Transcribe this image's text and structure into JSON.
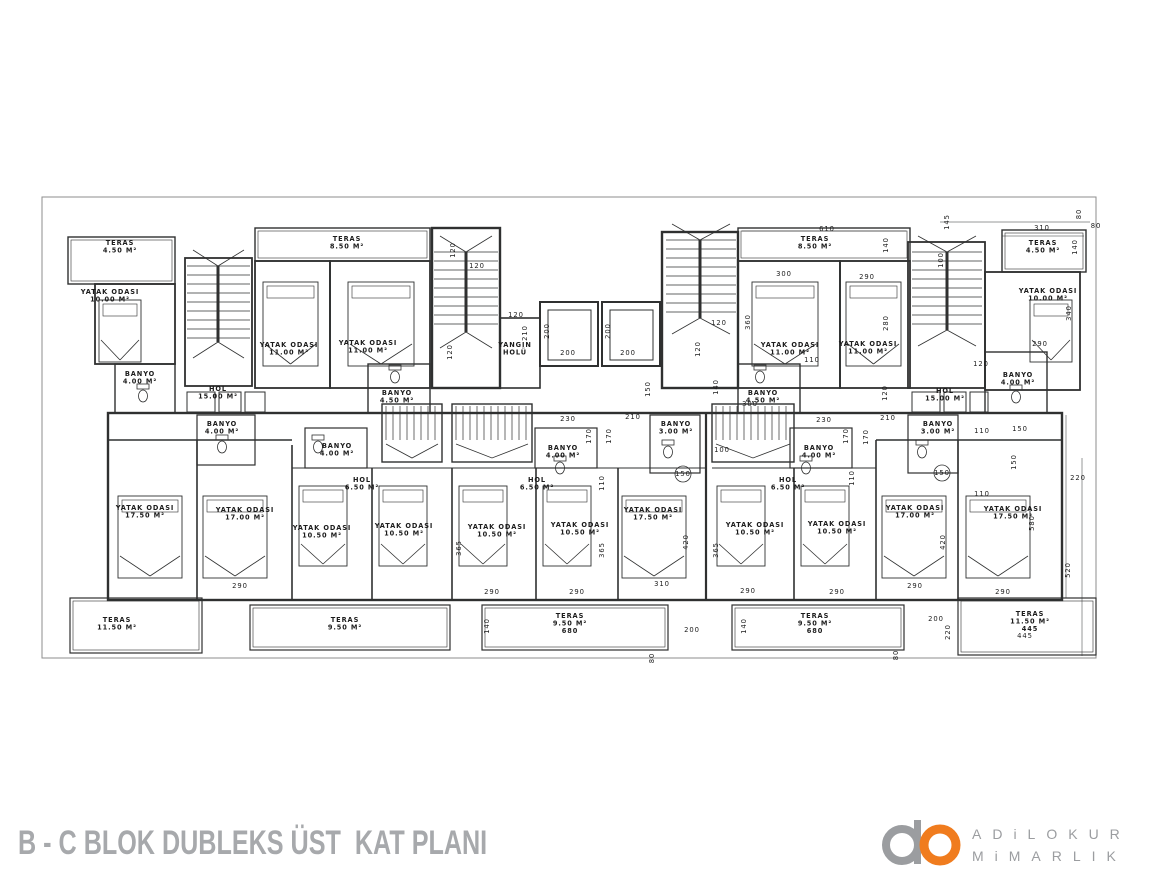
{
  "meta": {
    "title": "B - C BLOK DUBLEKS ÜST  KAT PLANI"
  },
  "logo": {
    "line1": "ADiLOKUR",
    "line2": "MiMARLIK",
    "gray": "#9b9da0",
    "orange": "#f07c1e"
  },
  "colors": {
    "line": "#2f3030",
    "boundary": "#8d8d8d",
    "label": "#1c1c1c",
    "title": "#a7a9ac"
  },
  "plan": {
    "rooms": [
      {
        "l1": "TERAS",
        "l2": "4.50 M²",
        "x": 120,
        "y": 245
      },
      {
        "l1": "YATAK ODASI",
        "l2": "10.00 M²",
        "x": 110,
        "y": 294
      },
      {
        "l1": "BANYO",
        "l2": "4.00 M²",
        "x": 140,
        "y": 376
      },
      {
        "l1": "HOL",
        "l2": "15.00 M²",
        "x": 218,
        "y": 391
      },
      {
        "l1": "TERAS",
        "l2": "8.50 M²",
        "x": 347,
        "y": 241
      },
      {
        "l1": "YATAK ODASI",
        "l2": "11.00 M²",
        "x": 289,
        "y": 347
      },
      {
        "l1": "YATAK ODASI",
        "l2": "11.00 M²",
        "x": 368,
        "y": 345
      },
      {
        "l1": "BANYO",
        "l2": "4.50 M²",
        "x": 397,
        "y": 395
      },
      {
        "l1": "YANGIN",
        "l2": "HOLÜ",
        "x": 515,
        "y": 347
      },
      {
        "l1": "TERAS",
        "l2": "8.50 M²",
        "x": 815,
        "y": 241
      },
      {
        "l1": "YATAK ODASI",
        "l2": "11.00 M²",
        "x": 790,
        "y": 347
      },
      {
        "l1": "YATAK ODASI",
        "l2": "11.00 M²",
        "x": 868,
        "y": 346
      },
      {
        "l1": "BANYO",
        "l2": "4.50 M²",
        "x": 763,
        "y": 395
      },
      {
        "l1": "HOL",
        "l2": "15.00 M²",
        "x": 945,
        "y": 393
      },
      {
        "l1": "TERAS",
        "l2": "4.50 M²",
        "x": 1043,
        "y": 245
      },
      {
        "l1": "YATAK ODASI",
        "l2": "10.00 M²",
        "x": 1048,
        "y": 293
      },
      {
        "l1": "BANYO",
        "l2": "4.00 M²",
        "x": 1018,
        "y": 377
      },
      {
        "l1": "BANYO",
        "l2": "4.00 M²",
        "x": 222,
        "y": 426
      },
      {
        "l1": "BANYO",
        "l2": "4.00 M²",
        "x": 337,
        "y": 448
      },
      {
        "l1": "BANYO",
        "l2": "4.00 M²",
        "x": 563,
        "y": 450
      },
      {
        "l1": "BANYO",
        "l2": "3.00 M²",
        "x": 676,
        "y": 426
      },
      {
        "l1": "BANYO",
        "l2": "4.00 M²",
        "x": 819,
        "y": 450
      },
      {
        "l1": "BANYO",
        "l2": "3.00 M²",
        "x": 938,
        "y": 426
      },
      {
        "l1": "HOL",
        "l2": "6.50 M²",
        "x": 362,
        "y": 482
      },
      {
        "l1": "HOL",
        "l2": "6.50 M²",
        "x": 537,
        "y": 482
      },
      {
        "l1": "HOL",
        "l2": "6.50 M²",
        "x": 788,
        "y": 482
      },
      {
        "l1": "YATAK ODASI",
        "l2": "17.50 M²",
        "x": 145,
        "y": 510
      },
      {
        "l1": "YATAK ODASI",
        "l2": "17.00 M²",
        "x": 245,
        "y": 512
      },
      {
        "l1": "YATAK ODASI",
        "l2": "10.50 M²",
        "x": 322,
        "y": 530
      },
      {
        "l1": "YATAK ODASI",
        "l2": "10.50 M²",
        "x": 404,
        "y": 528
      },
      {
        "l1": "YATAK ODASI",
        "l2": "10.50 M²",
        "x": 497,
        "y": 529
      },
      {
        "l1": "YATAK ODASI",
        "l2": "10.50 M²",
        "x": 580,
        "y": 527
      },
      {
        "l1": "YATAK ODASI",
        "l2": "17.50 M²",
        "x": 653,
        "y": 512
      },
      {
        "l1": "YATAK ODASI",
        "l2": "10.50 M²",
        "x": 755,
        "y": 527
      },
      {
        "l1": "YATAK ODASI",
        "l2": "10.50 M²",
        "x": 837,
        "y": 526
      },
      {
        "l1": "YATAK ODASI",
        "l2": "17.00 M²",
        "x": 915,
        "y": 510
      },
      {
        "l1": "YATAK ODASI",
        "l2": "17.50 M²",
        "x": 1013,
        "y": 511
      },
      {
        "l1": "TERAS",
        "l2": "11.50 M²",
        "x": 117,
        "y": 622
      },
      {
        "l1": "TERAS",
        "l2": "9.50 M²",
        "x": 345,
        "y": 622
      },
      {
        "l1": "TERAS",
        "l2": "9.50 M²",
        "l3": "680",
        "x": 570,
        "y": 618
      },
      {
        "l1": "TERAS",
        "l2": "9.50 M²",
        "l3": "680",
        "x": 815,
        "y": 618
      },
      {
        "l1": "TERAS",
        "l2": "11.50 M²",
        "l3": "445",
        "x": 1030,
        "y": 616
      }
    ],
    "dims": [
      {
        "v": "610",
        "x": 827,
        "y": 231,
        "r": 0
      },
      {
        "v": "140",
        "x": 888,
        "y": 245,
        "r": 1
      },
      {
        "v": "145",
        "x": 949,
        "y": 222,
        "r": 1
      },
      {
        "v": "310",
        "x": 1042,
        "y": 230,
        "r": 0
      },
      {
        "v": "80",
        "x": 1081,
        "y": 214,
        "r": 1
      },
      {
        "v": "80",
        "x": 1096,
        "y": 228,
        "r": 0
      },
      {
        "v": "140",
        "x": 1077,
        "y": 247,
        "r": 1
      },
      {
        "v": "340",
        "x": 1071,
        "y": 313,
        "r": 1
      },
      {
        "v": "290",
        "x": 1040,
        "y": 346,
        "r": 0
      },
      {
        "v": "120",
        "x": 981,
        "y": 366,
        "r": 0
      },
      {
        "v": "100",
        "x": 943,
        "y": 260,
        "r": 1
      },
      {
        "v": "120",
        "x": 455,
        "y": 250,
        "r": 1
      },
      {
        "v": "120",
        "x": 477,
        "y": 268,
        "r": 0
      },
      {
        "v": "120",
        "x": 452,
        "y": 352,
        "r": 1
      },
      {
        "v": "120",
        "x": 516,
        "y": 317,
        "r": 0
      },
      {
        "v": "210",
        "x": 527,
        "y": 333,
        "r": 1
      },
      {
        "v": "200",
        "x": 549,
        "y": 331,
        "r": 1
      },
      {
        "v": "200",
        "x": 568,
        "y": 355,
        "r": 0
      },
      {
        "v": "200",
        "x": 610,
        "y": 331,
        "r": 1
      },
      {
        "v": "200",
        "x": 628,
        "y": 355,
        "r": 0
      },
      {
        "v": "150",
        "x": 650,
        "y": 389,
        "r": 1
      },
      {
        "v": "120",
        "x": 719,
        "y": 325,
        "r": 0
      },
      {
        "v": "120",
        "x": 700,
        "y": 349,
        "r": 1
      },
      {
        "v": "140",
        "x": 718,
        "y": 387,
        "r": 1
      },
      {
        "v": "300",
        "x": 750,
        "y": 406,
        "r": 0
      },
      {
        "v": "110",
        "x": 812,
        "y": 362,
        "r": 0
      },
      {
        "v": "300",
        "x": 784,
        "y": 276,
        "r": 0
      },
      {
        "v": "290",
        "x": 867,
        "y": 279,
        "r": 0
      },
      {
        "v": "360",
        "x": 750,
        "y": 322,
        "r": 1
      },
      {
        "v": "280",
        "x": 888,
        "y": 323,
        "r": 1
      },
      {
        "v": "120",
        "x": 887,
        "y": 393,
        "r": 1
      },
      {
        "v": "230",
        "x": 568,
        "y": 421,
        "r": 0
      },
      {
        "v": "210",
        "x": 633,
        "y": 419,
        "r": 0
      },
      {
        "v": "170",
        "x": 591,
        "y": 436,
        "r": 1
      },
      {
        "v": "170",
        "x": 611,
        "y": 436,
        "r": 1
      },
      {
        "v": "110",
        "x": 604,
        "y": 483,
        "r": 1
      },
      {
        "v": "230",
        "x": 824,
        "y": 422,
        "r": 0
      },
      {
        "v": "210",
        "x": 888,
        "y": 420,
        "r": 0
      },
      {
        "v": "170",
        "x": 848,
        "y": 436,
        "r": 1
      },
      {
        "v": "170",
        "x": 868,
        "y": 437,
        "r": 1
      },
      {
        "v": "110",
        "x": 854,
        "y": 478,
        "r": 1
      },
      {
        "v": "100",
        "x": 722,
        "y": 452,
        "r": 0
      },
      {
        "v": "110",
        "x": 982,
        "y": 433,
        "r": 0
      },
      {
        "v": "150",
        "x": 1020,
        "y": 431,
        "r": 0
      },
      {
        "v": "150",
        "x": 1016,
        "y": 462,
        "r": 1
      },
      {
        "v": "110",
        "x": 982,
        "y": 496,
        "r": 0
      },
      {
        "v": "580",
        "x": 1034,
        "y": 523,
        "r": 1
      },
      {
        "v": "220",
        "x": 1078,
        "y": 480,
        "r": 0
      },
      {
        "v": "520",
        "x": 1070,
        "y": 570,
        "r": 1
      },
      {
        "v": "420",
        "x": 688,
        "y": 542,
        "r": 1
      },
      {
        "v": "365",
        "x": 718,
        "y": 550,
        "r": 1
      },
      {
        "v": "420",
        "x": 945,
        "y": 542,
        "r": 1
      },
      {
        "v": "365",
        "x": 461,
        "y": 548,
        "r": 1
      },
      {
        "v": "365",
        "x": 604,
        "y": 550,
        "r": 1
      },
      {
        "v": "290",
        "x": 240,
        "y": 588,
        "r": 0
      },
      {
        "v": "290",
        "x": 492,
        "y": 594,
        "r": 0
      },
      {
        "v": "290",
        "x": 577,
        "y": 594,
        "r": 0
      },
      {
        "v": "290",
        "x": 748,
        "y": 593,
        "r": 0
      },
      {
        "v": "290",
        "x": 837,
        "y": 594,
        "r": 0
      },
      {
        "v": "290",
        "x": 915,
        "y": 588,
        "r": 0
      },
      {
        "v": "290",
        "x": 1003,
        "y": 594,
        "r": 0
      },
      {
        "v": "310",
        "x": 662,
        "y": 586,
        "r": 0
      },
      {
        "v": "140",
        "x": 489,
        "y": 626,
        "r": 1
      },
      {
        "v": "140",
        "x": 746,
        "y": 626,
        "r": 1
      },
      {
        "v": "200",
        "x": 692,
        "y": 632,
        "r": 0
      },
      {
        "v": "80",
        "x": 654,
        "y": 658,
        "r": 1
      },
      {
        "v": "200",
        "x": 936,
        "y": 621,
        "r": 0
      },
      {
        "v": "220",
        "x": 950,
        "y": 632,
        "r": 1
      },
      {
        "v": "445",
        "x": 1025,
        "y": 638,
        "r": 0
      },
      {
        "v": "80",
        "x": 898,
        "y": 655,
        "r": 1
      },
      {
        "v": "150",
        "x": 683,
        "y": 476,
        "r": 0
      },
      {
        "v": "150",
        "x": 942,
        "y": 475,
        "r": 0
      }
    ]
  }
}
